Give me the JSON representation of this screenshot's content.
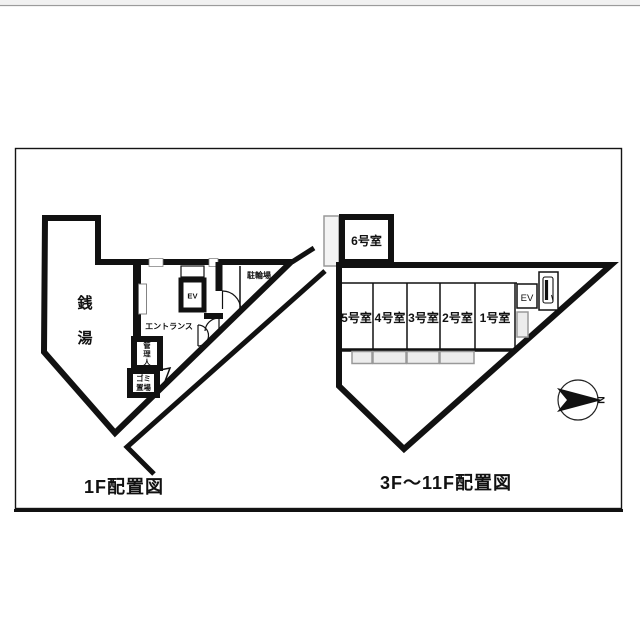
{
  "document": {
    "background": "#ffffff",
    "top_rule_color": "#9b9b9b",
    "frame_color": "#141414"
  },
  "colors": {
    "wall": "#111111",
    "balcony_fill": "#ececec",
    "balcony_stroke": "#999999"
  },
  "floor1": {
    "caption": "1F配置図",
    "sento": [
      "銭",
      "湯"
    ],
    "entrance": "エントランス",
    "elevator": "EV",
    "bicycle": "駐輪場",
    "manager": [
      "管",
      "理",
      "人"
    ],
    "garbage": [
      "ゴミ",
      "置場"
    ]
  },
  "upper_floors": {
    "caption": "3F～11F配置図",
    "room6": "6号室",
    "rooms": [
      "5号室",
      "4号室",
      "3号室",
      "2号室",
      "1号室"
    ],
    "elevator": "EV"
  },
  "compass": {
    "north_label": "N"
  }
}
